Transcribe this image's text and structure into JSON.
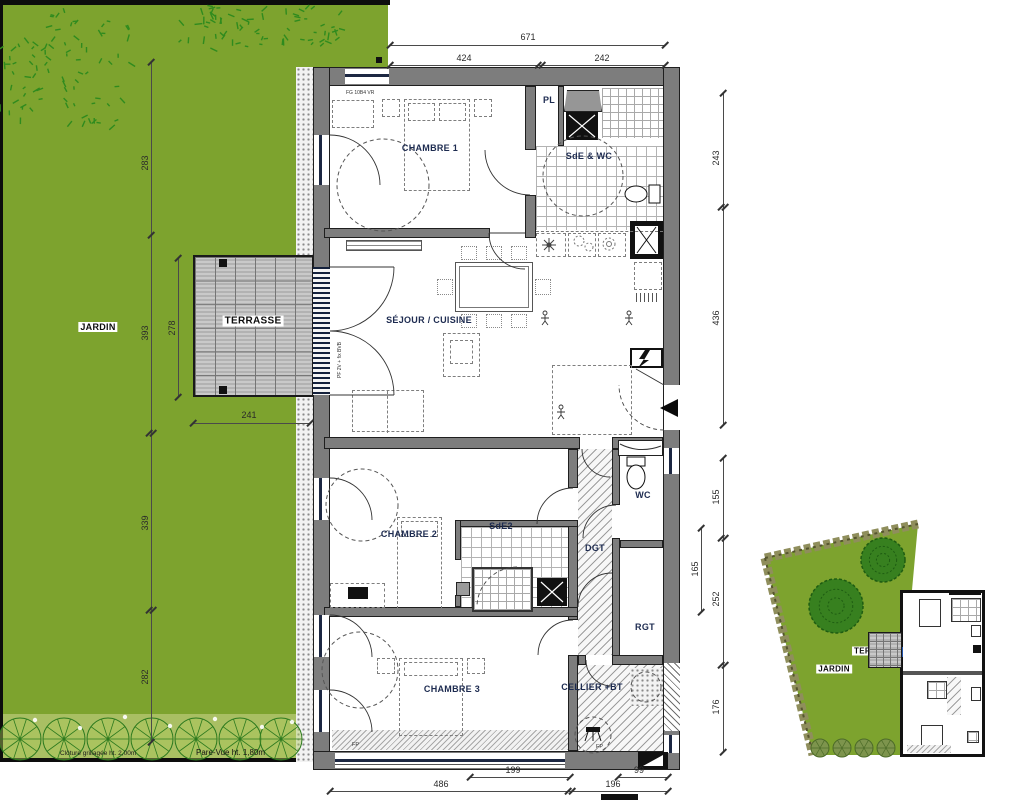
{
  "colors": {
    "garden_green": "#7da32e",
    "wall_gray": "#7d7d7d",
    "room_label_navy": "#1d2b50",
    "window_frame_navy": "#1c2742"
  },
  "plan": {
    "rooms": {
      "chambre1": "CHAMBRE 1",
      "sde_wc": "SdE & WC",
      "pl": "PL",
      "sejour_cuisine": "SÉJOUR / CUISINE",
      "chambre2": "CHAMBRE 2",
      "sde2": "SdE2",
      "dgt": "DGT",
      "wc": "WC",
      "rgt": "RGT",
      "chambre3": "CHAMBRE 3",
      "cellier": "CELLIER +BT"
    },
    "outdoor": {
      "jardin": "JARDIN",
      "terrasse": "TERRASSE"
    },
    "annotations": {
      "window_top": "FG 10B4 VR",
      "window_terrace": "PF 2V + fix BVB",
      "fp_left": "FP",
      "fp_right": "FP",
      "fence": "Clôture grillagée ht. 2,00m",
      "screen": "Pare-Vue ht. 1,80m"
    },
    "dimensions": {
      "top_total": "671",
      "top_left": "424",
      "top_right": "242",
      "right_upper_1": "243",
      "right_upper_2": "436",
      "right_lower_1": "155",
      "right_lower_2": "252",
      "right_lower_3": "176",
      "right_inner": "165",
      "left_1": "283",
      "left_2": "393",
      "left_3": "339",
      "left_4": "282",
      "terrace_height": "278",
      "terrace_width": "241",
      "bottom_inner_left": "199",
      "bottom_inner_right": "99",
      "bottom_left": "486",
      "bottom_right": "196"
    }
  },
  "inset": {
    "jardin": "JARDIN",
    "terrasse": "TERRASSE"
  }
}
